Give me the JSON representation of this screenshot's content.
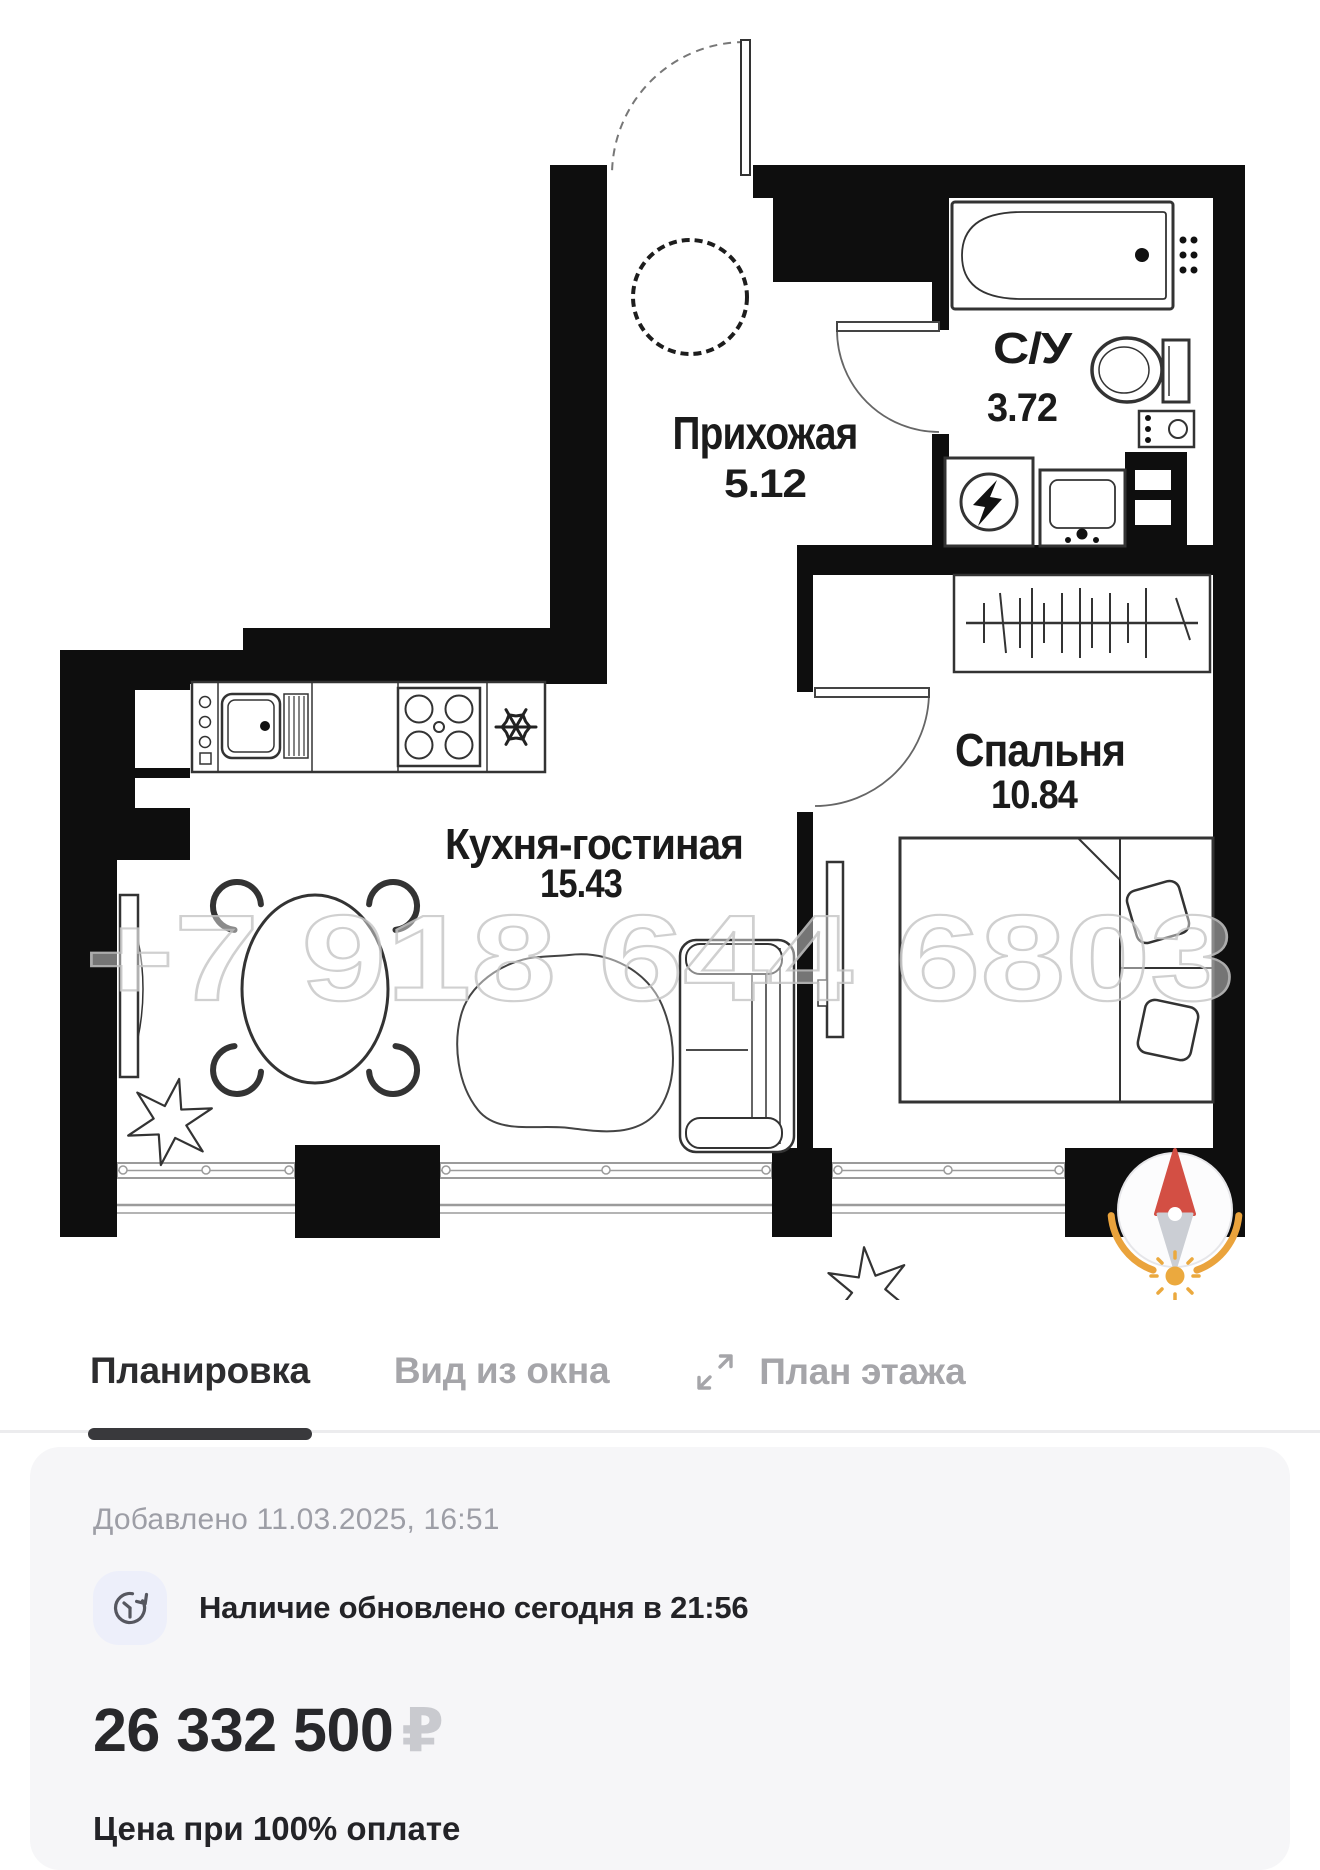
{
  "floor_plan": {
    "watermark": "+7 918 644 6803",
    "rooms": [
      {
        "name": "Прихожая",
        "area": "5.12"
      },
      {
        "name": "С/У",
        "area": "3.72"
      },
      {
        "name": "Кухня-гостиная",
        "area": "15.43"
      },
      {
        "name": "Спальня",
        "area": "10.84"
      }
    ]
  },
  "tabs": [
    {
      "label": "Планировка",
      "active": true
    },
    {
      "label": "Вид из окна",
      "active": false
    },
    {
      "label": "План этажа",
      "active": false
    }
  ],
  "info": {
    "added": "Добавлено 11.03.2025, 16:51",
    "availability": "Наличие обновлено сегодня в 21:56",
    "price": "26 332 500",
    "currency": "₽",
    "price_note": "Цена при 100% оплате"
  },
  "colors": {
    "walls": "#0e0e0e",
    "compass_north": "#d34f44",
    "compass_orange": "#eaa33c",
    "tab_active": "#2d2d2f",
    "tab_inactive": "#a5a5a9",
    "card_bg": "#f6f6f8",
    "badge_bg": "#edeffa",
    "watermark_stroke": "#c8c8c8"
  }
}
